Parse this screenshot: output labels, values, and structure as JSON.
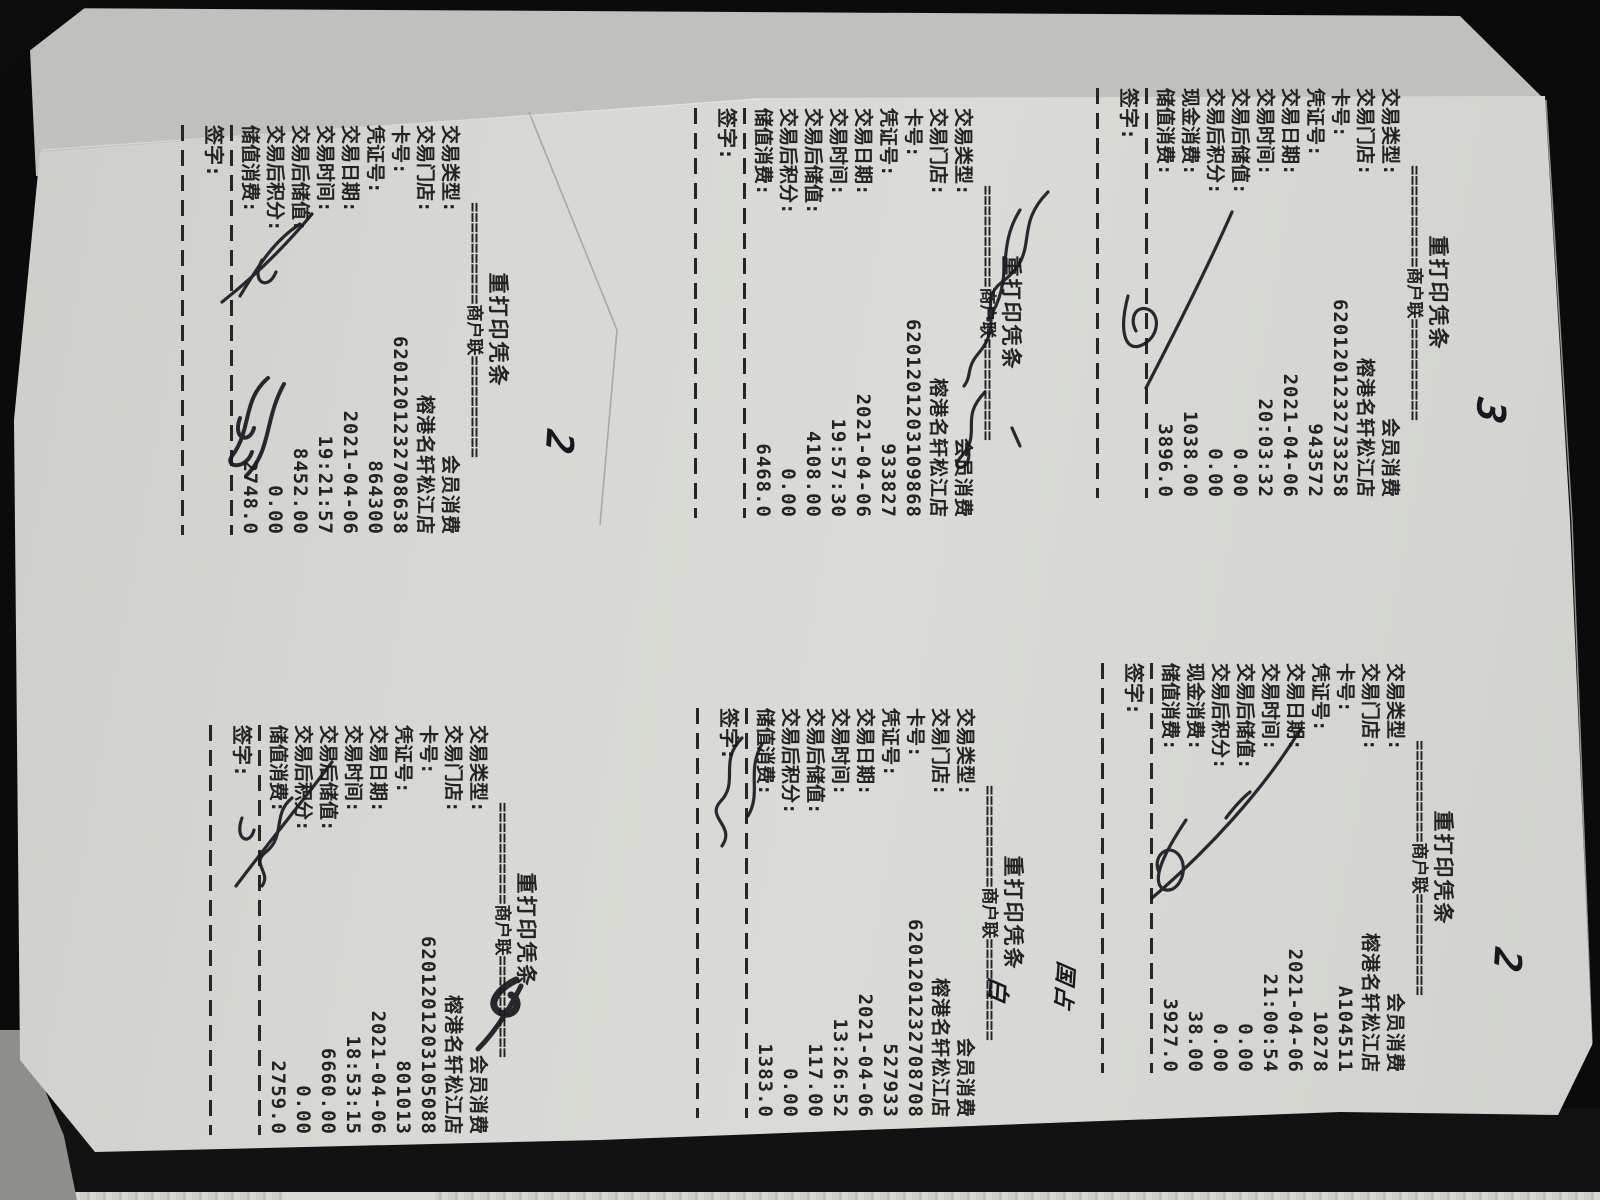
{
  "document": {
    "kind": "photo of a photocopied sheet with six reprinted POS receipts, receipts rotated 90 degrees clockwise",
    "store_date": "2021-04-06"
  },
  "receipts": [
    {
      "id": "top-left",
      "title": "重打印凭条",
      "copy_line": "==========商户联==========",
      "sign_label": "签字:",
      "fields": [
        {
          "label": "交易类型:",
          "value": "会员消费"
        },
        {
          "label": "交易门店:",
          "value": "榕港名轩松江店"
        },
        {
          "label": "卡号:",
          "value": "6201201232708638"
        },
        {
          "label": "凭证号:",
          "value": "864300"
        },
        {
          "label": "交易日期:",
          "value": "2021-04-06"
        },
        {
          "label": "交易时间:",
          "value": "19:21:57"
        },
        {
          "label": "交易后储值:",
          "value": "8452.00"
        },
        {
          "label": "交易后积分:",
          "value": "0.00"
        },
        {
          "label": "储值消费:",
          "value": "2748.0"
        }
      ]
    },
    {
      "id": "top-middle",
      "title": "重打印凭条",
      "copy_line": "==========商户联==========",
      "sign_label": "签字:",
      "fields": [
        {
          "label": "交易类型:",
          "value": "会员消费"
        },
        {
          "label": "交易门店:",
          "value": "榕港名轩松江店"
        },
        {
          "label": "卡号:",
          "value": "6201201203109868"
        },
        {
          "label": "凭证号:",
          "value": "933827"
        },
        {
          "label": "交易日期:",
          "value": "2021-04-06"
        },
        {
          "label": "交易时间:",
          "value": "19:57:30"
        },
        {
          "label": "交易后储值:",
          "value": "4108.00"
        },
        {
          "label": "交易后积分:",
          "value": "0.00"
        },
        {
          "label": "储值消费:",
          "value": "6468.0"
        }
      ]
    },
    {
      "id": "top-right",
      "title": "重打印凭条",
      "copy_line": "==========商户联==========",
      "sign_label": "签字:",
      "fields": [
        {
          "label": "交易类型:",
          "value": "会员消费"
        },
        {
          "label": "交易门店:",
          "value": "榕港名轩松江店"
        },
        {
          "label": "卡号:",
          "value": "6201201232733258"
        },
        {
          "label": "凭证号:",
          "value": "943572"
        },
        {
          "label": "交易日期:",
          "value": "2021-04-06"
        },
        {
          "label": "交易时间:",
          "value": "20:03:32"
        },
        {
          "label": "交易后储值:",
          "value": "0.00"
        },
        {
          "label": "交易后积分:",
          "value": "0.00"
        },
        {
          "label": "现金消费:",
          "value": "1038.00"
        },
        {
          "label": "储值消费:",
          "value": "3896.0"
        }
      ]
    },
    {
      "id": "bottom-left",
      "title": "重打印凭条",
      "copy_line": "==========商户联==========",
      "sign_label": "签字:",
      "fields": [
        {
          "label": "交易类型:",
          "value": "会员消费"
        },
        {
          "label": "交易门店:",
          "value": "榕港名轩松江店"
        },
        {
          "label": "卡号:",
          "value": "6201201203105088"
        },
        {
          "label": "凭证号:",
          "value": "801013"
        },
        {
          "label": "交易日期:",
          "value": "2021-04-06"
        },
        {
          "label": "交易时间:",
          "value": "18:53:15"
        },
        {
          "label": "交易后储值:",
          "value": "6660.00"
        },
        {
          "label": "交易后积分:",
          "value": "0.00"
        },
        {
          "label": "储值消费:",
          "value": "2759.0"
        }
      ]
    },
    {
      "id": "bottom-middle",
      "title": "重打印凭条",
      "copy_line": "==========商户联==========",
      "sign_label": "签字:",
      "fields": [
        {
          "label": "交易类型:",
          "value": "会员消费"
        },
        {
          "label": "交易门店:",
          "value": "榕港名轩松江店"
        },
        {
          "label": "卡号:",
          "value": "6201201232708708"
        },
        {
          "label": "凭证号:",
          "value": "527933"
        },
        {
          "label": "交易日期:",
          "value": "2021-04-06"
        },
        {
          "label": "交易时间:",
          "value": "13:26:52"
        },
        {
          "label": "交易后储值:",
          "value": "117.00"
        },
        {
          "label": "交易后积分:",
          "value": "0.00"
        },
        {
          "label": "储值消费:",
          "value": "1383.0"
        }
      ]
    },
    {
      "id": "bottom-right",
      "title": "重打印凭条",
      "copy_line": "==========商户联==========",
      "sign_label": "签字:",
      "fields": [
        {
          "label": "交易类型:",
          "value": "会员消费"
        },
        {
          "label": "交易门店:",
          "value": "榕港名轩松江店"
        },
        {
          "label": "卡号:",
          "value": "A104511"
        },
        {
          "label": "凭证号:",
          "value": "10278"
        },
        {
          "label": "交易日期:",
          "value": "2021-04-06"
        },
        {
          "label": "交易时间:",
          "value": "21:00:54"
        },
        {
          "label": "交易后储值:",
          "value": "0.00"
        },
        {
          "label": "交易后积分:",
          "value": "0.00"
        },
        {
          "label": "现金消费:",
          "value": "38.00"
        },
        {
          "label": "储值消费:",
          "value": "3927.0"
        }
      ]
    }
  ],
  "annotations": [
    {
      "id": "note-3-top",
      "text": "3",
      "placement": "beside top-right receipt header"
    },
    {
      "id": "note-2-mid",
      "text": "2",
      "placement": "beside top-middle receipt"
    },
    {
      "id": "note-2-bottom",
      "text": "2",
      "placement": "beside bottom-right receipt header"
    },
    {
      "id": "note-bai",
      "text": "白",
      "placement": "beside bottom-middle receipt"
    },
    {
      "id": "note-guozhan",
      "text": "国占",
      "placement": "beside bottom-middle receipt"
    }
  ],
  "handwritten_signatures": [
    "top-left",
    "top-middle",
    "top-right",
    "bottom-left",
    "bottom-middle",
    "bottom-right"
  ],
  "colors": {
    "paper": "#d7d8d3",
    "under_sheet": "#c0c1bc",
    "toner": "#232323",
    "ink": "#17171e",
    "background": "#0b0b0b"
  }
}
